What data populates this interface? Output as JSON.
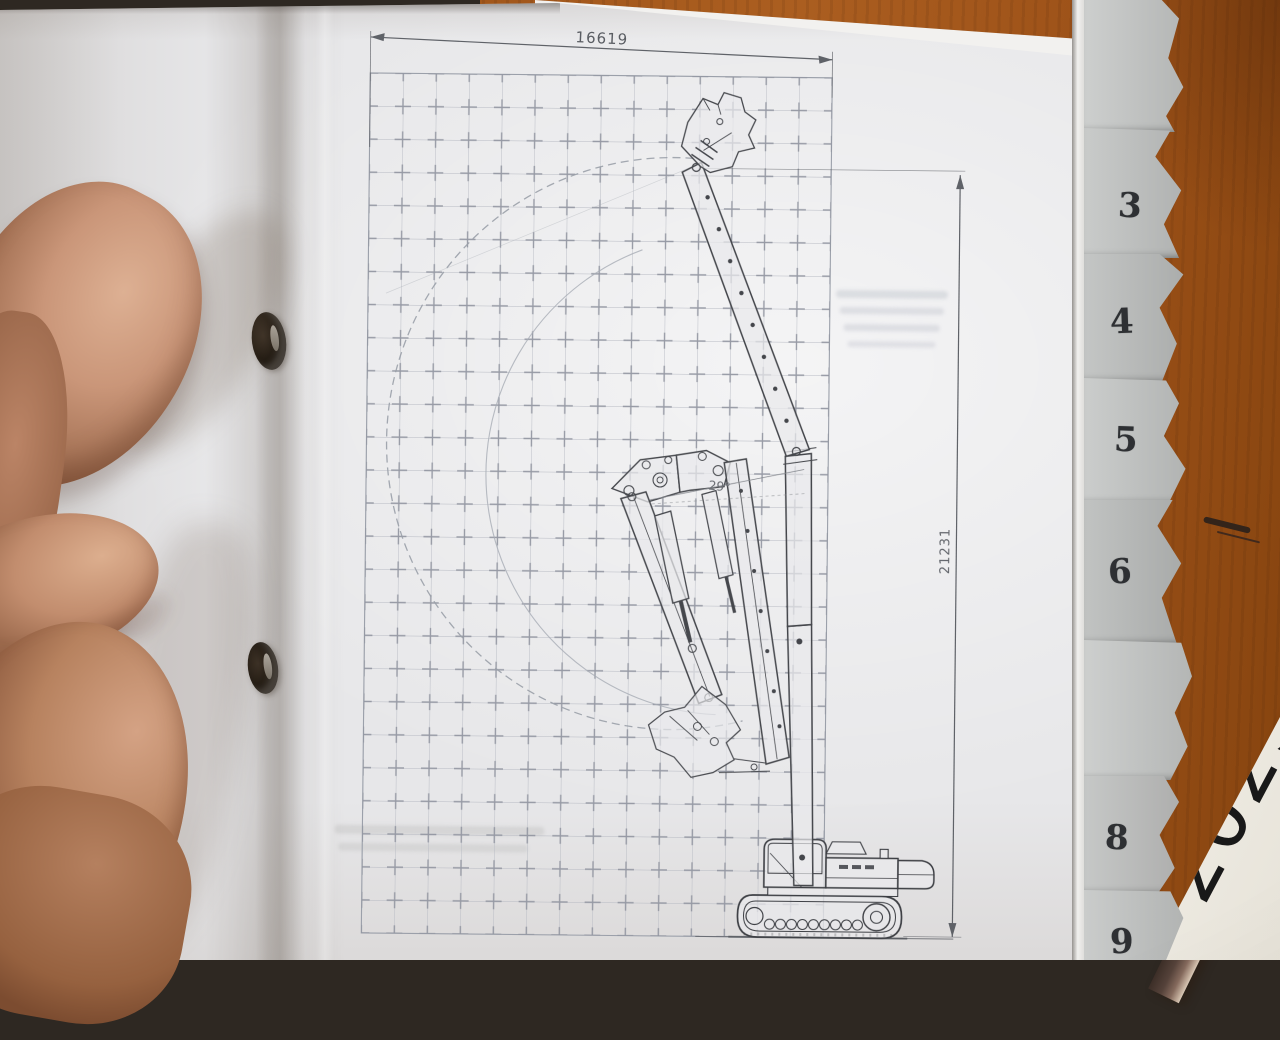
{
  "diagram": {
    "width_dim": "16619",
    "height_dim": "21231",
    "boom_angle": "29°"
  },
  "tabs": {
    "items": [
      {
        "label": "3"
      },
      {
        "label": "4"
      },
      {
        "label": "5"
      },
      {
        "label": "6"
      },
      {
        "label": "8"
      },
      {
        "label": "9"
      }
    ]
  },
  "plate": {
    "year": "2025"
  },
  "colors": {
    "desk_wood": "#a2571b",
    "page": "#e7e7e9",
    "pencil_line": "#55585e",
    "grid_line": "#b6b9c2",
    "tab_paper": "#c2c4c3",
    "plate_face": "#ece9e1"
  }
}
